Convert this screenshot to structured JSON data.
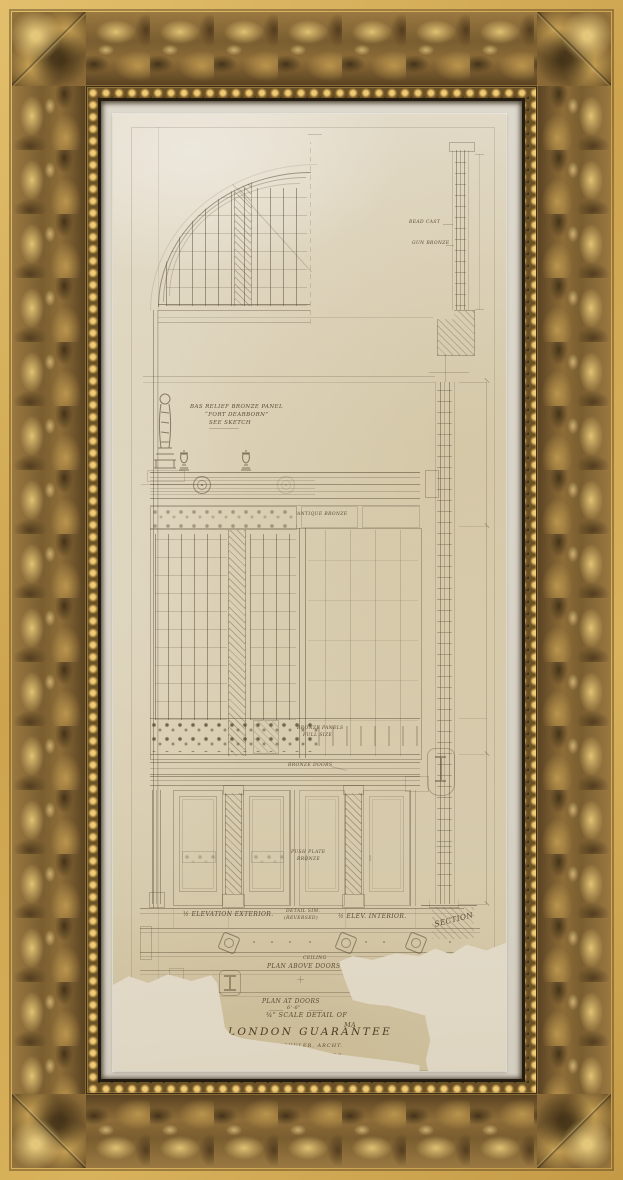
{
  "colors": {
    "frame_gold_light": "#e9cb79",
    "frame_gold": "#9a7841",
    "frame_gold_dark": "#594222",
    "frame_outer_band": "#d2ab55",
    "liner_gold": "#eecb76",
    "rabbet_shadow": "#241c11",
    "mat": "#d9d4c7",
    "paper": "#d8cdae",
    "paper_tear_light": "#efe9dd",
    "ink_sepia": "#5c4d38"
  },
  "labels": {
    "bead_cast": "BEAD CAST",
    "gun_bronze": "GUN BRONZE",
    "bas_relief_1": "BAS RELIEF BRONZE PANEL",
    "bas_relief_2": "“FORT DEARBORN”",
    "bas_relief_3": "SEE SKETCH",
    "antique_bronze": "ANTIQUE BRONZE",
    "bronze_panels_1": "BRONZE PANELS",
    "bronze_panels_2": "FULL SIZE",
    "bronze_doors": "BRONZE DOORS",
    "push_plate_1": "PUSH PLATE",
    "push_plate_2": "BRONZE",
    "elev_exterior": "½ ELEVATION EXTERIOR.",
    "detail_sim": "DETAIL SIM.",
    "reversed": "(REVERSED)",
    "elev_interior": "½ ELEV. INTERIOR.",
    "section": "SECTION",
    "ceiling": "CEILING",
    "plan_above_doors": "PLAN ABOVE DOORS",
    "plan_at_doors": "PLAN AT DOORS",
    "dim_6_6": "6'-6\""
  },
  "title_block": {
    "scale_line": "¾\" SCALE DETAIL OF",
    "scale_cont": "MA",
    "name": "LONDON GUARANTEE",
    "architect": "ALFRED S. ALSCHULER, ARCHT.",
    "address": "1900 STRAUS BLDG. CHICAGO."
  }
}
